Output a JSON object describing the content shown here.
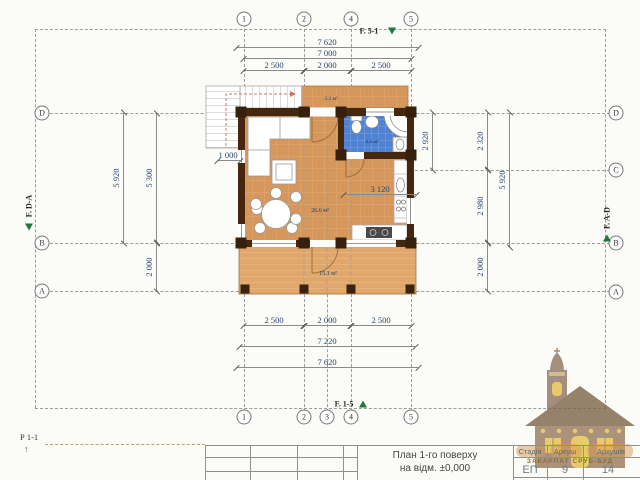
{
  "axes": {
    "top": [
      "1",
      "2",
      "4",
      "5"
    ],
    "bottom": [
      "1",
      "2",
      "3",
      "4",
      "5"
    ],
    "left": [
      "D",
      "B",
      "A"
    ],
    "right": [
      "D",
      "C",
      "B",
      "A"
    ]
  },
  "facades": {
    "top": "F. 5-1",
    "bottom": "F. 1-5",
    "left": "F. D-A",
    "right": "F. A-D"
  },
  "section_label": "Р 1-1",
  "dims": {
    "top": {
      "overall": "7 620",
      "between_axes": "7 000",
      "seg_1_2": "2 500",
      "seg_2_4": "2 000",
      "seg_4_5": "2 500"
    },
    "bottom": {
      "seg_1_2": "2 500",
      "seg_2_4": "2 000",
      "seg_4_5": "2 500",
      "inner": "7 220",
      "overall": "7 620"
    },
    "left": {
      "outer": "5 920",
      "inner": "5 300",
      "terrace": "2 000",
      "stair": "1 000"
    },
    "right": {
      "bath_outer": "2 920",
      "bath_inner": "2 320",
      "kitchen": "2 980",
      "terrace": "2 000",
      "outer": "5 920"
    },
    "interior": {
      "kitchen_width": "3 120"
    }
  },
  "rooms": {
    "living": {
      "area": "26.6 м²"
    },
    "bathroom": {
      "area": "4.6 м²"
    },
    "terrace": {
      "area": "15.1 м²"
    },
    "porch": {
      "area": "2.2 м²"
    }
  },
  "title_block": {
    "title_line1": "План 1-го поверху",
    "title_line2": "на відм. ±0,000",
    "company": "ЗАКАРПАТ СРУБ-БУД",
    "columns": [
      {
        "label": "Стадія",
        "value": "ЕП"
      },
      {
        "label": "Аркуш",
        "value": "9"
      },
      {
        "label": "Аркушів",
        "value": "14"
      }
    ]
  },
  "colors": {
    "floor_wood": "#d6975c",
    "terrace_wood": "#dfa76b",
    "log_wall": "#45260f",
    "bath_tile": "#4f82d2",
    "dimension_text": "#2a4570",
    "facade_marker_green": "#1b7a3a",
    "logo_brown": "#8f7360",
    "logo_yellow": "#e3c04a"
  }
}
